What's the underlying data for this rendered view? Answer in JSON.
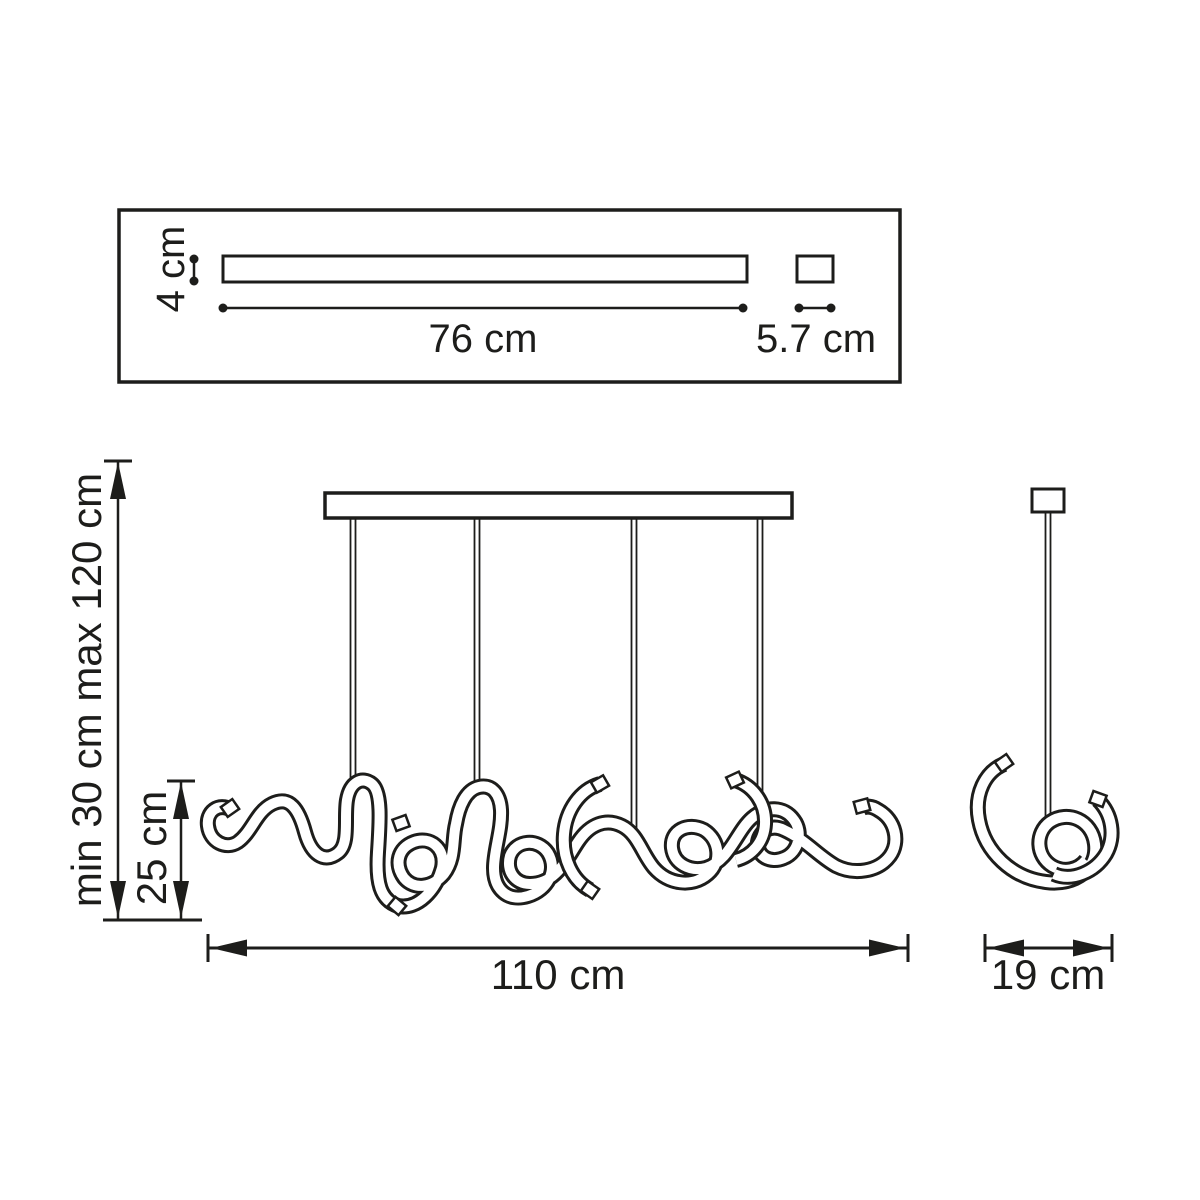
{
  "colors": {
    "ink": "#1d1d1b",
    "background": "#ffffff"
  },
  "top_panel": {
    "bar_width_label": "76 cm",
    "bar_thickness_label": "4 cm",
    "canopy_width_label": "5.7 cm"
  },
  "front_view": {
    "suspension_height_label": "min 30 cm max 120 cm",
    "fixture_height_label": "25 cm",
    "fixture_width_label": "110 cm"
  },
  "side_view": {
    "fixture_depth_label": "19 cm"
  }
}
